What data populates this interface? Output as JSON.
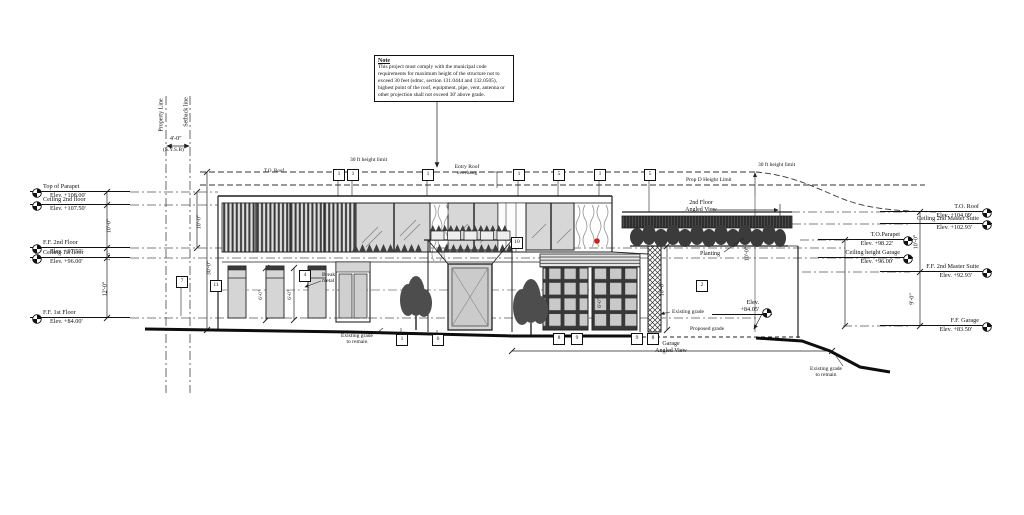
{
  "title": "Front Elevation",
  "colors": {
    "line": "#1a1a1a",
    "glass": "#d7d7d7",
    "dark_slat": "#3a3a3a",
    "red_dot": "#cc2020"
  },
  "note": {
    "title": "Note",
    "body": "This project must comply with the municipal code requirements for maximum height of the structure not to exceed 30 feet (sdmc, section 131.0444 and 132.0505), highest point of the roof, equipment, pipe, vent, antenna or other projection shall not exceed 30' above grade."
  },
  "site": {
    "property_line": "Property Line",
    "setback_line": "Setback line",
    "setback_tag": "(S.Y.S.B)"
  },
  "limits": {
    "left": "30 ft height limit",
    "right": "30 ft height limit",
    "prop_d": "Prop D Height Limit"
  },
  "left_markers": [
    {
      "label": "Top of Parapet",
      "elev": "Elev. +108.00'"
    },
    {
      "label": "Ceiling 2nd floor",
      "elev": "Elev. +107.50'"
    },
    {
      "label": "F.F. 2nd Floor",
      "elev": "Elev. +97.50'"
    },
    {
      "label": "Ceiling 1st floor",
      "elev": "Elev. +96.00'"
    },
    {
      "label": "F.F. 1st Floor",
      "elev": "Elev. +84.00'"
    }
  ],
  "right_markers": [
    {
      "label": "T.O. Roof",
      "elev": "Elev. +104.09'"
    },
    {
      "label": "Ceiling 2nd Master Suite",
      "elev": "Elev. +102.93'"
    },
    {
      "label": "F.F. 2nd Master Suite",
      "elev": "Elev. +92.93'"
    },
    {
      "label": "F.F. Garage",
      "elev": "Elev. +83.50'"
    }
  ],
  "inner_markers": [
    {
      "label": "T.O.Parapet",
      "elev": "Elev. +98.22'"
    },
    {
      "label": "Ceiling height Garage",
      "elev": "Elev. +96.00'"
    }
  ],
  "grade_marker": {
    "line1": "Elev.",
    "line2": "+84.05'"
  },
  "annotations": {
    "to_roof": "T.O. Roof",
    "entry_roof_1": "Entry Roof",
    "entry_roof_2": "overhang",
    "second_floor_1": "2nd Floor",
    "second_floor_2": "Angled View",
    "planting": "Planting",
    "break_metal_1": "Break",
    "break_metal_2": "metal",
    "existing_grade_remain_1": "Existing grade",
    "existing_grade_remain_2": "to remain",
    "existing_grade": "Existing grade",
    "proposed_grade": "Proposed grade",
    "garage_1": "Garage",
    "garage_2": "Angled View",
    "existing_grade_remain_r1": "Existing grade",
    "existing_grade_remain_r2": "to remain"
  },
  "dims": {
    "a": "10'-0\"",
    "b": "1'-6\"",
    "c": "12'-0\"",
    "d": "10'-0\"",
    "e": "30'-0\"",
    "f": "10'-0\"",
    "g": "9'-0\"",
    "h": "10'-0\"",
    "i": "10'-0\"",
    "j": "6'-0\"",
    "k": "6'-0\"",
    "l": "6'-0\"",
    "m": "4'-0\""
  },
  "callouts": {
    "r1": "1",
    "r2": "1",
    "r3": "1",
    "r4": "1",
    "r5": "5",
    "r6": "1",
    "r7": "5",
    "w11": "11",
    "w7": "7",
    "w4": "4",
    "w10": "10",
    "w2": "2",
    "b1": "1",
    "b2": "6",
    "b3": "8",
    "b4": "9",
    "b5": "9",
    "b6": "8"
  }
}
